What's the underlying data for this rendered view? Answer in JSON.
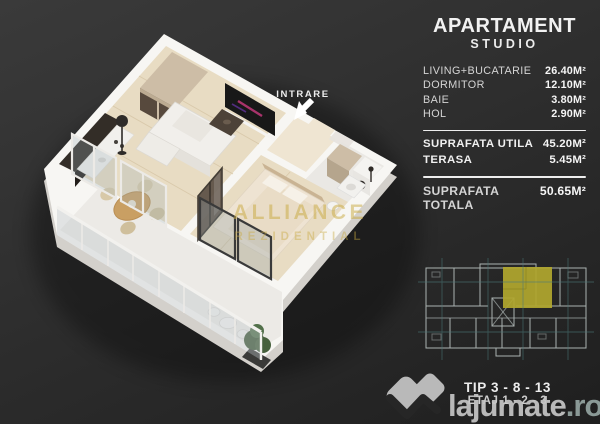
{
  "panel": {
    "title_line1": "APARTAMENT",
    "title_line2": "STUDIO",
    "rooms": [
      {
        "label": "LIVING+BUCATARIE",
        "value": "26.40M²"
      },
      {
        "label": "DORMITOR",
        "value": "12.10M²"
      },
      {
        "label": "BAIE",
        "value": "3.80M²"
      },
      {
        "label": "HOL",
        "value": "2.90M²"
      }
    ],
    "subtotals": [
      {
        "label": "SUPRAFATA UTILA",
        "value": "45.20M²"
      },
      {
        "label": "TERASA",
        "value": "5.45M²"
      }
    ],
    "total": {
      "label": "SUPRAFATA TOTALA",
      "value": "50.65M²"
    }
  },
  "plan": {
    "entrance_label": "INTRARE",
    "watermark_line1": "ALLIANCE",
    "watermark_line2": "REZIDENTIAL"
  },
  "unit_info": {
    "tip": "TIP 3 - 8 - 13",
    "etaj": "ETAJ 1 - 2 - 3"
  },
  "brand": {
    "name": "lajumate",
    "tld": ".ro"
  },
  "colors": {
    "background": "#2e2e2e",
    "accent_gold": "#c9a93f",
    "unit_highlight": "#b0a72e",
    "schematic_teal": "#4a7878",
    "brand_gray": "#c6c6c6"
  }
}
